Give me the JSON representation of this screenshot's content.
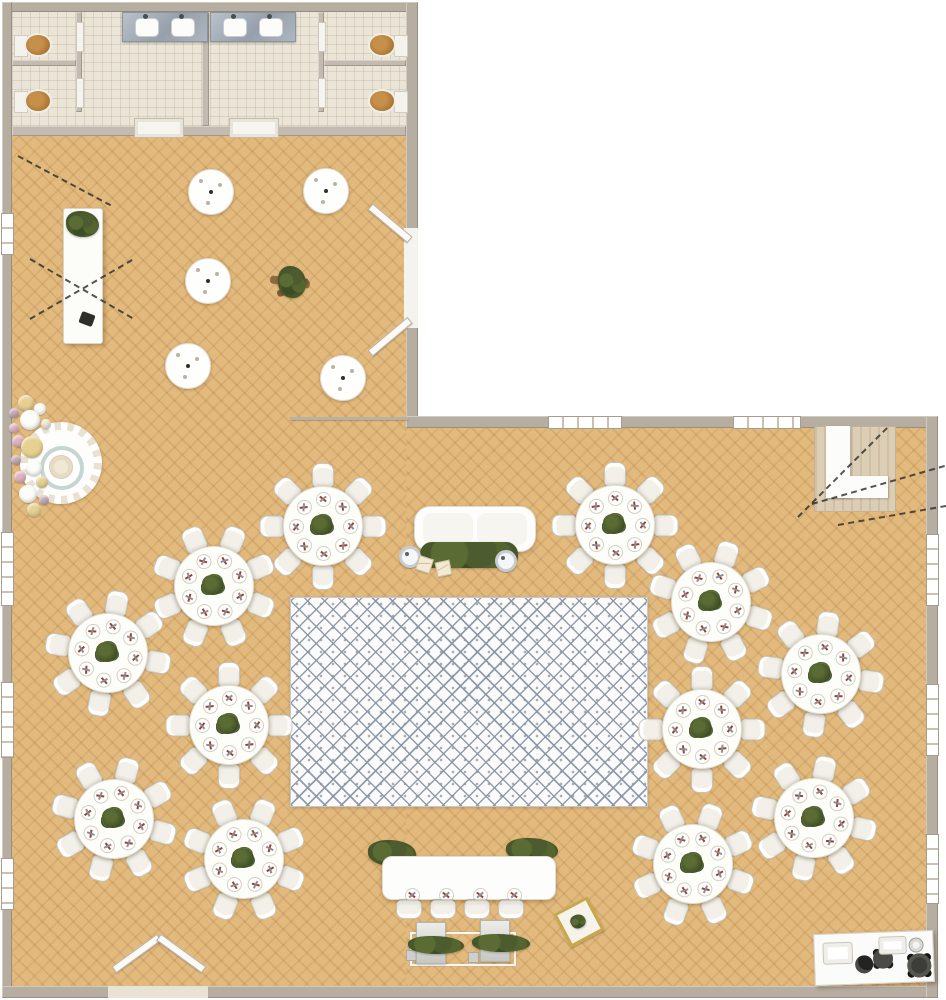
{
  "scene": {
    "width": 946,
    "height": 1000,
    "kind": "event-venue-floor-plan",
    "shape": "L-shaped hall with two restrooms"
  },
  "colors": {
    "wood_floor": "#e3ba7e",
    "tile_floor": "#ebe5d8",
    "wall": "#b7aea2",
    "dance_floor_accent": "#8e9bab",
    "table_white": "#fdfdfa",
    "chair_cream": "#f2f0e8",
    "place_setting_accent": "#a23d31",
    "greenery": "#4c5c2e",
    "marble_vanity": "#a6aeb8",
    "gold_accent": "#c9a84c",
    "balloon_gold": "#e6d18f",
    "balloon_pink": "#dfb3c2",
    "balloon_mauve": "#c3a9b4",
    "balloon_cream": "#efe6d3",
    "balloon_white": "#fcfcfa"
  },
  "dance_floor": {
    "x": 290,
    "y": 597,
    "w": 356,
    "h": 208
  },
  "dining_tables": {
    "seats_per_table": 8,
    "table_diameter_px": 78,
    "positions": [
      {
        "x": 322,
        "y": 525,
        "rot": 0
      },
      {
        "x": 213,
        "y": 585,
        "rot": 22
      },
      {
        "x": 107,
        "y": 652,
        "rot": 10
      },
      {
        "x": 228,
        "y": 724,
        "rot": 0
      },
      {
        "x": 113,
        "y": 818,
        "rot": 15
      },
      {
        "x": 243,
        "y": 858,
        "rot": 22
      },
      {
        "x": 614,
        "y": 524,
        "rot": 0
      },
      {
        "x": 710,
        "y": 601,
        "rot": 18
      },
      {
        "x": 820,
        "y": 673,
        "rot": 8
      },
      {
        "x": 701,
        "y": 728,
        "rot": 0
      },
      {
        "x": 813,
        "y": 817,
        "rot": 12
      },
      {
        "x": 692,
        "y": 863,
        "rot": 20
      }
    ]
  },
  "cocktail_tables": {
    "diameter_px": 44,
    "positions": [
      {
        "x": 210,
        "y": 191
      },
      {
        "x": 325,
        "y": 190
      },
      {
        "x": 207,
        "y": 280
      },
      {
        "x": 187,
        "y": 365
      },
      {
        "x": 342,
        "y": 377
      }
    ]
  },
  "head_table": {
    "seats": 4,
    "x": 382,
    "y": 856,
    "w": 172,
    "h": 42,
    "chair_offsets": [
      14,
      48,
      82,
      116
    ]
  },
  "restrooms": {
    "count": 2,
    "toilets": 4,
    "sinks": 4,
    "stalls": 4
  },
  "balloons": [
    {
      "x": 26,
      "y": 403,
      "r": 8,
      "c": "balloon_gold"
    },
    {
      "x": 14,
      "y": 413,
      "r": 5,
      "c": "balloon_mauve"
    },
    {
      "x": 40,
      "y": 409,
      "r": 6,
      "c": "balloon_white"
    },
    {
      "x": 30,
      "y": 420,
      "r": 10,
      "c": "balloon_white"
    },
    {
      "x": 14,
      "y": 428,
      "r": 5,
      "c": "balloon_pink"
    },
    {
      "x": 46,
      "y": 424,
      "r": 5,
      "c": "balloon_cream"
    },
    {
      "x": 18,
      "y": 441,
      "r": 6,
      "c": "balloon_pink"
    },
    {
      "x": 32,
      "y": 447,
      "r": 11,
      "c": "balloon_gold"
    },
    {
      "x": 16,
      "y": 460,
      "r": 5,
      "c": "balloon_mauve"
    },
    {
      "x": 34,
      "y": 468,
      "r": 8,
      "c": "balloon_white"
    },
    {
      "x": 20,
      "y": 477,
      "r": 6,
      "c": "balloon_pink"
    },
    {
      "x": 42,
      "y": 482,
      "r": 6,
      "c": "balloon_gold"
    },
    {
      "x": 28,
      "y": 494,
      "r": 9,
      "c": "balloon_white"
    },
    {
      "x": 44,
      "y": 500,
      "r": 5,
      "c": "balloon_mauve"
    },
    {
      "x": 34,
      "y": 510,
      "r": 7,
      "c": "balloon_gold"
    }
  ],
  "string_lights": [
    {
      "x": 798,
      "y": 516,
      "len": 126,
      "deg": -45
    },
    {
      "x": 812,
      "y": 503,
      "len": 138,
      "deg": -16
    },
    {
      "x": 838,
      "y": 524,
      "len": 110,
      "deg": -10
    },
    {
      "x": 18,
      "y": 155,
      "len": 105,
      "deg": 28
    },
    {
      "x": 30,
      "y": 258,
      "len": 118,
      "deg": 30
    },
    {
      "x": 30,
      "y": 318,
      "len": 118,
      "deg": -30
    }
  ]
}
